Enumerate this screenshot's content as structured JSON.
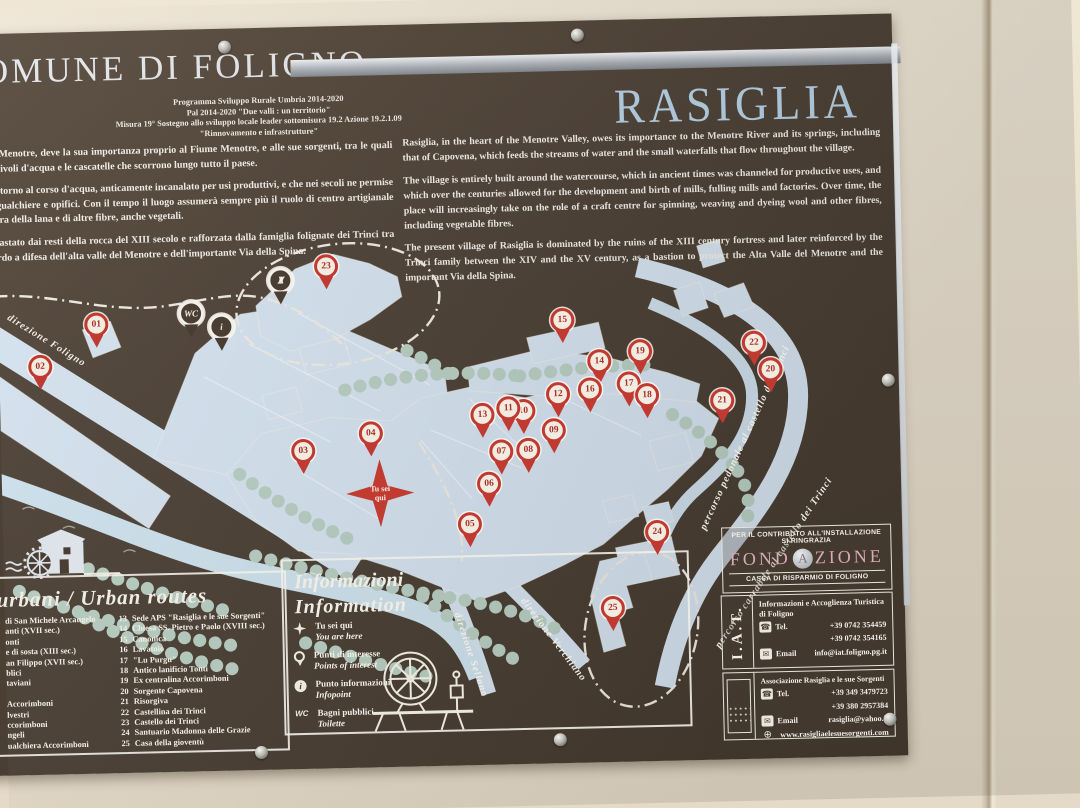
{
  "colors": {
    "board_brown": "#4b3f34",
    "map_blue": "#d6e4f1",
    "tree_green": "#b9cfc3",
    "marker_red": "#c03a31",
    "title_blue": "#b7d2e6",
    "foundation_pink": "#d8a9b6",
    "wall_beige": "#e9dfce"
  },
  "icon_names": [
    "mill-icon",
    "spinning-wheel-icon",
    "star-icon",
    "pin-icon",
    "info-icon",
    "wc-icon",
    "chapel-icon",
    "phone-icon",
    "email-icon",
    "globe-icon",
    "screw"
  ],
  "header": {
    "municipality": "COMUNE DI FOLIGNO",
    "program_lines": [
      "Programma Sviluppo Rurale Umbria 2014-2020",
      "Pal 2014-2020 \"Due valli : un territorio\"",
      "Misura 19° Sostegno allo sviluppo locale leader sottomisura 19.2 Azione 19.2.1.09",
      "\"Rinnovamento e infrastrutture\""
    ]
  },
  "title": "RASIGLIA",
  "intro": {
    "italian_paragraphs": [
      "a Valle del Menotre, deve la sua importanza proprio al Fiume Menotre, e alle sue sorgenti, tra le quali alimenta i rivoli d'acqua e le cascatelle che scorrono lungo tutto il paese.",
      "costruito attorno al corso d'acqua, anticamente incanalato per usi produttivi, e che nei secoli ne permise di mulini, gualchiere e opifici. Con il tempo il luogo assumerà sempre più il ruolo di centro artigianale per la tintura della lana e di altre fibre, anche vegetali.",
      "iglia è sovrastato dai resti della rocca del XIII secolo e rafforzata dalla famiglia folignate dei Trinci tra il ne baluardo a difesa dell'alta valle del Menotre e dell'importante Via della Spina."
    ],
    "english_paragraphs": [
      "Rasiglia, in the heart of the Menotre Valley, owes its importance to the Menotre River and its springs, including that of Capovena, which feeds the streams of water and the small waterfalls that flow throughout the village.",
      "The village is entirely built around the watercourse, which in ancient times was channeled for productive uses, and which over the centuries allowed for the development and birth of mills, fulling mills and factories. Over time, the place will increasingly take on the role of a craft centre for spinning, weaving and dyeing wool and other fibres, including vegetable fibres.",
      "The present village of Rasiglia is dominated by the ruins of the XIII century fortress and later reinforced by the Trinci family between the XIV and the XV century, as a bastion to protect the Alta Valle del Menotre and the important Via della Spina."
    ]
  },
  "map": {
    "you_are_here": {
      "line1": "Tu sei",
      "line2": "qui"
    },
    "markers": [
      {
        "n": "01",
        "x": 98,
        "y": 317
      },
      {
        "n": "02",
        "x": 41,
        "y": 358
      },
      {
        "n": "03",
        "x": 302,
        "y": 448
      },
      {
        "n": "04",
        "x": 370,
        "y": 432
      },
      {
        "n": "05",
        "x": 467,
        "y": 525
      },
      {
        "n": "06",
        "x": 487,
        "y": 485
      },
      {
        "n": "07",
        "x": 500,
        "y": 453
      },
      {
        "n": "08",
        "x": 527,
        "y": 452
      },
      {
        "n": "09",
        "x": 553,
        "y": 433
      },
      {
        "n": "10",
        "x": 523,
        "y": 413
      },
      {
        "n": "11",
        "x": 508,
        "y": 410
      },
      {
        "n": "12",
        "x": 558,
        "y": 397
      },
      {
        "n": "13",
        "x": 482,
        "y": 416
      },
      {
        "n": "14",
        "x": 600,
        "y": 365
      },
      {
        "n": "15",
        "x": 564,
        "y": 323
      },
      {
        "n": "16",
        "x": 590,
        "y": 393
      },
      {
        "n": "17",
        "x": 629,
        "y": 388
      },
      {
        "n": "18",
        "x": 647,
        "y": 400
      },
      {
        "n": "19",
        "x": 641,
        "y": 356
      },
      {
        "n": "20",
        "x": 771,
        "y": 377
      },
      {
        "n": "21",
        "x": 722,
        "y": 407
      },
      {
        "n": "22",
        "x": 755,
        "y": 350
      },
      {
        "n": "23",
        "x": 329,
        "y": 264
      },
      {
        "n": "24",
        "x": 654,
        "y": 537
      },
      {
        "n": "25",
        "x": 608,
        "y": 612
      }
    ],
    "icon_pins": [
      {
        "name": "wc-pin",
        "label": "WC",
        "x": 193,
        "y": 308
      },
      {
        "name": "info-pin",
        "label": "i",
        "x": 223,
        "y": 322
      },
      {
        "name": "chapel-pin",
        "label": "",
        "x": 283,
        "y": 277
      }
    ],
    "road_labels": [
      {
        "text": "direzione Foligno",
        "x": 10,
        "y": 302,
        "rot": 33
      },
      {
        "text": "direzione Sellano",
        "x": 452,
        "y": 608,
        "rot": 73
      },
      {
        "text": "direzione Verchiano",
        "x": 518,
        "y": 596,
        "rot": 54
      },
      {
        "text": "percorso pedonale al castello dei Trinci",
        "x": 700,
        "y": 530,
        "rot": -64
      },
      {
        "text": "percorso carrabile al castello dei Trinci",
        "x": 712,
        "y": 648,
        "rot": -55
      }
    ]
  },
  "legend_routes": {
    "title": "urbani / Urban routes",
    "left_items": [
      "di San Michele Arcangelo",
      "anti (XVII sec.)",
      "onti",
      "e di sosta (XIII sec.)",
      "an Filippo (XVII sec.)",
      "blici",
      "taviani",
      "",
      "Accorimboni",
      "lvestri",
      "ccorimboni",
      "ngeli",
      "ualchiera Accorimboni"
    ],
    "right_items": [
      {
        "n": "13",
        "label": "Sede APS \"Rasiglia e le sue Sorgenti\""
      },
      {
        "n": "14",
        "label": "Chiesa SS. Pietro e Paolo (XVIII sec.)"
      },
      {
        "n": "15",
        "label": "Canonica"
      },
      {
        "n": "16",
        "label": "Lavatoio"
      },
      {
        "n": "17",
        "label": "\"Lu Purgu\""
      },
      {
        "n": "18",
        "label": "Antico lanificio Tonti"
      },
      {
        "n": "19",
        "label": "Ex centralina Accorimboni"
      },
      {
        "n": "20",
        "label": "Sorgente Capovena"
      },
      {
        "n": "21",
        "label": "Risorgiva"
      },
      {
        "n": "22",
        "label": "Castellina dei Trinci"
      },
      {
        "n": "23",
        "label": "Castello dei Trinci"
      },
      {
        "n": "24",
        "label": "Santuario Madonna delle Grazie"
      },
      {
        "n": "25",
        "label": "Casa della gioventù"
      }
    ]
  },
  "legend_info": {
    "title_it": "Informazioni",
    "title_en": "Information",
    "items": [
      {
        "icon": "star-icon",
        "it": "Tu sei qui",
        "en": "You are here"
      },
      {
        "icon": "pin-icon",
        "it": "Punti di interesse",
        "en": "Points of interest"
      },
      {
        "icon": "info-icon",
        "it": "Punto informazioni",
        "en": "Infopoint"
      },
      {
        "icon": "wc-icon",
        "it": "Bagni pubblici",
        "en": "Toilette"
      }
    ]
  },
  "credits": {
    "thanks_line1": "PER IL CONTRIBUTO ALL'INSTALLAZIONE",
    "thanks_line2": "SI RINGRAZIA",
    "foundation_pre": "FOND",
    "foundation_a": "A",
    "foundation_post": "ZIONE",
    "foundation_sub": "CASSA DI RISPARMIO DI FOLIGNO"
  },
  "iat": {
    "logo": "I.A.T.",
    "org_line1": "Informazioni e Accoglienza Turistica",
    "org_line2": "di Foligno",
    "tel_label": "Tel.",
    "phone1": "+39 0742 354459",
    "phone2": "+39 0742 354165",
    "email_label": "Email",
    "email": "info@iat.foligno.pg.it"
  },
  "association": {
    "org": "Associazione Rasiglia e le sue Sorgenti",
    "tel_label": "Tel.",
    "phone1": "+39 349 3479723",
    "phone2": "+39 380 2957384",
    "email_label": "Email",
    "email": "rasiglia@yahoo.it",
    "web": "www.rasigliaelesuesorgenti.com"
  }
}
